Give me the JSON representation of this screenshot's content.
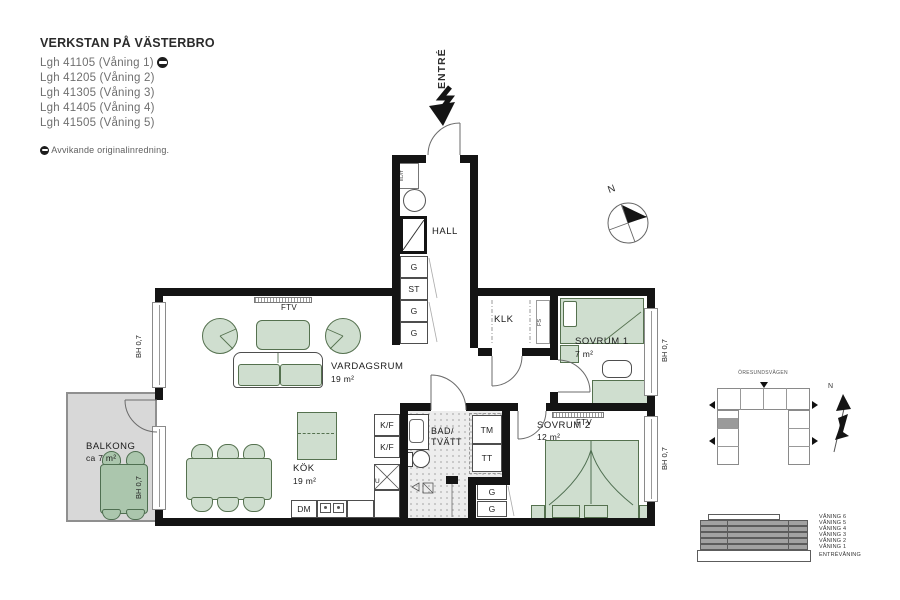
{
  "header": {
    "title": "VERKSTAN PÅ VÄSTERBRO",
    "apartments": [
      "Lgh 41105 (Våning 1)",
      "Lgh 41205 (Våning 2)",
      "Lgh 41305 (Våning 3)",
      "Lgh 41405 (Våning 4)",
      "Lgh 41505 (Våning 5)"
    ],
    "note": "Avvikande originalinredning."
  },
  "entrance": {
    "label": "ENTRÉ"
  },
  "compass": {
    "north": "N"
  },
  "plan": {
    "rooms": {
      "hall": {
        "name": "HALL"
      },
      "vardagsrum": {
        "name": "VARDAGSRUM",
        "area": "19 m²"
      },
      "kok": {
        "name": "KÖK",
        "area": "19 m²"
      },
      "sovrum1": {
        "name": "SOVRUM 1",
        "area": "7 m²"
      },
      "sovrum2": {
        "name": "SOVRUM 2",
        "area": "12 m²"
      },
      "klk": {
        "name": "KLK"
      },
      "bad": {
        "line1": "BAD/",
        "line2": "TVÄTT"
      },
      "balkong": {
        "name": "BALKONG",
        "area": "ca 7 m²"
      }
    },
    "fixtures": {
      "hall_closets": [
        "G",
        "ST",
        "G",
        "G"
      ],
      "elit": "EL/IT",
      "fs": "FS",
      "kf": "K/F",
      "dm": "DM",
      "oven": "U",
      "tm": "TM",
      "tt": "TT",
      "g": "G",
      "ftv": "FTV",
      "bh": "BH 0,7"
    }
  },
  "overview": {
    "street": "ÖRESUNDSVÄGEN",
    "north": "N"
  },
  "floors": [
    "VÅNING 6",
    "VÅNING 5",
    "VÅNING 4",
    "VÅNING 3",
    "VÅNING 2",
    "VÅNING 1",
    "ENTRÉVÅNING"
  ],
  "colors": {
    "wall": "#141414",
    "furniture": "#cfdecf",
    "furniture_outline": "#55714f",
    "balcony_furniture": "#abc6ad",
    "balcony_floor": "#d8d8d8",
    "bath_floor": "#ededed"
  }
}
